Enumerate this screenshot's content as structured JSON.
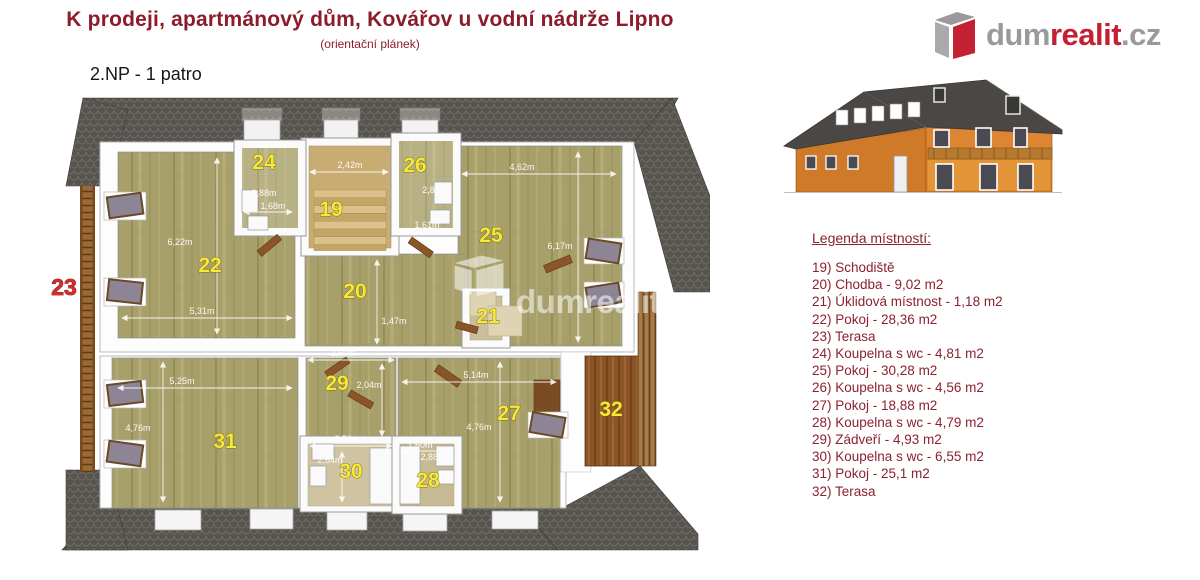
{
  "header": {
    "title": "K prodeji, apartmánový dům, Kovářov u vodní nádrže Lipno",
    "subtitle": "(orientační plánek)",
    "floor_label": "2.NP - 1 patro"
  },
  "logo": {
    "dum": "dum",
    "realit": "realit",
    "cz": ".cz"
  },
  "watermark": {
    "text": "dumrealit.cz"
  },
  "legend": {
    "title": "Legenda místností:",
    "items": [
      "19) Schodiště",
      "20) Chodba - 9,02 m2",
      "21) Úklidová místnost - 1,18 m2",
      "22) Pokoj - 28,36 m2",
      "23) Terasa",
      "24) Koupelna s wc - 4,81 m2",
      "25) Pokoj - 30,28 m2",
      "26) Koupelna s wc - 4,56 m2",
      "27) Pokoj - 18,88 m2",
      "28) Koupelna s wc - 4,79 m2",
      "29) Zádveří - 4,93 m2",
      "30) Koupelna s wc - 6,55 m2",
      "31) Pokoj - 25,1 m2",
      "32) Terasa"
    ]
  },
  "plan": {
    "rooms": {
      "r19": "19",
      "r20": "20",
      "r21": "21",
      "r22": "22",
      "r23": "23",
      "r24": "24",
      "r25": "25",
      "r26": "26",
      "r27": "27",
      "r28": "28",
      "r29": "29",
      "r30": "30",
      "r31": "31",
      "r32": "32"
    },
    "dims": {
      "d19w": "2,42m",
      "d24a": "2,88m",
      "d24b": "1,68m",
      "d26a": "2,83",
      "d26b": "1,61m",
      "d25w": "4,62m",
      "d25h": "6,17m",
      "d22h": "6,22m",
      "d22w": "5,31m",
      "d20h": "1,47m",
      "d29w": "2,50m",
      "d29h": "2,04m",
      "d30w": "2,50m",
      "d30h": "2,64m",
      "d28w": "1,60m",
      "d28h": "2,88m",
      "d27w": "5,14m",
      "d27h": "4,76m",
      "d31w": "5,25m",
      "d31h": "4,76m"
    }
  },
  "colors": {
    "accent_red": "#8c1c2b",
    "logo_red": "#c32033",
    "logo_gray": "#9b999c",
    "room_label_yellow": "#f8e83a",
    "terrace_label_red": "#d62b2b",
    "roof_dark": "#57534e",
    "floor_khaki": "#a8a06a",
    "facade_orange": "#dd8531"
  }
}
